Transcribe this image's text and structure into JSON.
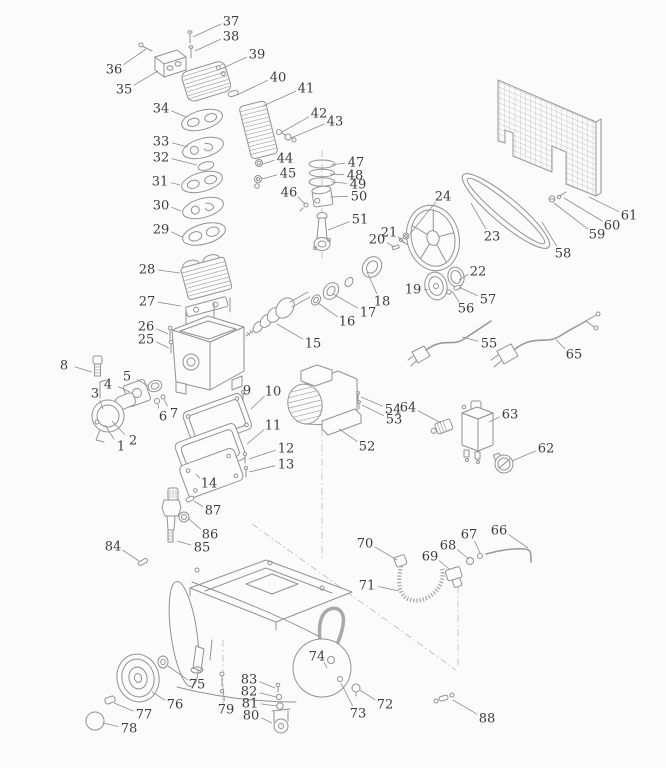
{
  "figure": {
    "type": "exploded-parts-diagram",
    "subject_hint": "belt-driven air compressor exploded view",
    "canvas": {
      "width": 666,
      "height": 768
    },
    "colors": {
      "background": "#fbfbfb",
      "line": "#929292",
      "label": "#3c3c3c",
      "leader": "#8c8c8c"
    },
    "label_font_size": 13,
    "part_count": 88
  },
  "labels": [
    {
      "n": "1",
      "x": 121,
      "y": 446,
      "ex": 105,
      "ey": 425
    },
    {
      "n": "2",
      "x": 133,
      "y": 440,
      "ex": 112,
      "ey": 421
    },
    {
      "n": "3",
      "x": 95,
      "y": 393,
      "ex": 103,
      "ey": 409
    },
    {
      "n": "4",
      "x": 108,
      "y": 384,
      "ex": 130,
      "ey": 392
    },
    {
      "n": "5",
      "x": 127,
      "y": 376,
      "ex": 148,
      "ey": 386
    },
    {
      "n": "6",
      "x": 163,
      "y": 416,
      "ex": 158,
      "ey": 404
    },
    {
      "n": "7",
      "x": 174,
      "y": 413,
      "ex": 164,
      "ey": 399
    },
    {
      "n": "8",
      "x": 64,
      "y": 365,
      "ex": 92,
      "ey": 372
    },
    {
      "n": "9",
      "x": 247,
      "y": 390,
      "ex": 243,
      "ey": 398
    },
    {
      "n": "10",
      "x": 273,
      "y": 391,
      "ex": 251,
      "ey": 409
    },
    {
      "n": "11",
      "x": 273,
      "y": 425,
      "ex": 247,
      "ey": 444
    },
    {
      "n": "12",
      "x": 286,
      "y": 448,
      "ex": 249,
      "ey": 459
    },
    {
      "n": "13",
      "x": 286,
      "y": 464,
      "ex": 249,
      "ey": 472
    },
    {
      "n": "14",
      "x": 209,
      "y": 483,
      "ex": 196,
      "ey": 474
    },
    {
      "n": "15",
      "x": 313,
      "y": 343,
      "ex": 277,
      "ey": 324
    },
    {
      "n": "16",
      "x": 347,
      "y": 321,
      "ex": 318,
      "ey": 303
    },
    {
      "n": "17",
      "x": 368,
      "y": 312,
      "ex": 333,
      "ey": 294
    },
    {
      "n": "18",
      "x": 382,
      "y": 301,
      "ex": 367,
      "ey": 272
    },
    {
      "n": "19",
      "x": 413,
      "y": 289,
      "ex": 428,
      "ey": 290
    },
    {
      "n": "20",
      "x": 377,
      "y": 239,
      "ex": 394,
      "ey": 247
    },
    {
      "n": "21",
      "x": 389,
      "y": 232,
      "ex": 404,
      "ey": 243
    },
    {
      "n": "22",
      "x": 478,
      "y": 271,
      "ex": 459,
      "ey": 280
    },
    {
      "n": "23",
      "x": 492,
      "y": 236,
      "ex": 471,
      "ey": 203
    },
    {
      "n": "24",
      "x": 443,
      "y": 196,
      "ex": 410,
      "ey": 234
    },
    {
      "n": "25",
      "x": 146,
      "y": 339,
      "ex": 169,
      "ey": 348
    },
    {
      "n": "26",
      "x": 146,
      "y": 326,
      "ex": 168,
      "ey": 334
    },
    {
      "n": "27",
      "x": 147,
      "y": 301,
      "ex": 181,
      "ey": 306
    },
    {
      "n": "28",
      "x": 147,
      "y": 269,
      "ex": 180,
      "ey": 273
    },
    {
      "n": "29",
      "x": 161,
      "y": 229,
      "ex": 182,
      "ey": 237
    },
    {
      "n": "30",
      "x": 161,
      "y": 205,
      "ex": 181,
      "ey": 211
    },
    {
      "n": "31",
      "x": 160,
      "y": 181,
      "ex": 180,
      "ey": 185
    },
    {
      "n": "32",
      "x": 161,
      "y": 157,
      "ex": 197,
      "ey": 165
    },
    {
      "n": "33",
      "x": 161,
      "y": 141,
      "ex": 188,
      "ey": 147
    },
    {
      "n": "34",
      "x": 161,
      "y": 108,
      "ex": 186,
      "ey": 117
    },
    {
      "n": "35",
      "x": 124,
      "y": 89,
      "ex": 158,
      "ey": 71
    },
    {
      "n": "36",
      "x": 114,
      "y": 69,
      "ex": 146,
      "ey": 49
    },
    {
      "n": "37",
      "x": 231,
      "y": 21,
      "ex": 193,
      "ey": 37
    },
    {
      "n": "38",
      "x": 231,
      "y": 36,
      "ex": 195,
      "ey": 51
    },
    {
      "n": "39",
      "x": 257,
      "y": 54,
      "ex": 221,
      "ey": 69
    },
    {
      "n": "40",
      "x": 278,
      "y": 77,
      "ex": 237,
      "ey": 95
    },
    {
      "n": "41",
      "x": 306,
      "y": 88,
      "ex": 263,
      "ey": 106
    },
    {
      "n": "42",
      "x": 319,
      "y": 113,
      "ex": 282,
      "ey": 132
    },
    {
      "n": "43",
      "x": 335,
      "y": 121,
      "ex": 291,
      "ey": 138
    },
    {
      "n": "44",
      "x": 285,
      "y": 158,
      "ex": 263,
      "ey": 164
    },
    {
      "n": "45",
      "x": 288,
      "y": 173,
      "ex": 262,
      "ey": 179
    },
    {
      "n": "46",
      "x": 289,
      "y": 192,
      "ex": 305,
      "ey": 204
    },
    {
      "n": "47",
      "x": 356,
      "y": 162,
      "ex": 331,
      "ey": 165
    },
    {
      "n": "48",
      "x": 355,
      "y": 175,
      "ex": 330,
      "ey": 174
    },
    {
      "n": "49",
      "x": 358,
      "y": 184,
      "ex": 331,
      "ey": 182
    },
    {
      "n": "50",
      "x": 359,
      "y": 196,
      "ex": 330,
      "ey": 197
    },
    {
      "n": "51",
      "x": 360,
      "y": 219,
      "ex": 328,
      "ey": 230
    },
    {
      "n": "52",
      "x": 367,
      "y": 446,
      "ex": 339,
      "ey": 429
    },
    {
      "n": "53",
      "x": 394,
      "y": 419,
      "ex": 362,
      "ey": 405
    },
    {
      "n": "54",
      "x": 393,
      "y": 409,
      "ex": 361,
      "ey": 397
    },
    {
      "n": "55",
      "x": 489,
      "y": 343,
      "ex": 462,
      "ey": 337
    },
    {
      "n": "56",
      "x": 466,
      "y": 308,
      "ex": 452,
      "ey": 291
    },
    {
      "n": "57",
      "x": 488,
      "y": 299,
      "ex": 459,
      "ey": 287
    },
    {
      "n": "58",
      "x": 563,
      "y": 253,
      "ex": 542,
      "ey": 222
    },
    {
      "n": "59",
      "x": 597,
      "y": 234,
      "ex": 554,
      "ey": 203
    },
    {
      "n": "60",
      "x": 612,
      "y": 225,
      "ex": 564,
      "ey": 198
    },
    {
      "n": "61",
      "x": 629,
      "y": 215,
      "ex": 589,
      "ey": 197
    },
    {
      "n": "62",
      "x": 546,
      "y": 448,
      "ex": 512,
      "ey": 461
    },
    {
      "n": "63",
      "x": 510,
      "y": 414,
      "ex": 489,
      "ey": 422
    },
    {
      "n": "64",
      "x": 408,
      "y": 407,
      "ex": 441,
      "ey": 423
    },
    {
      "n": "65",
      "x": 574,
      "y": 354,
      "ex": 556,
      "ey": 340
    },
    {
      "n": "66",
      "x": 499,
      "y": 530,
      "ex": 528,
      "ey": 548
    },
    {
      "n": "67",
      "x": 469,
      "y": 534,
      "ex": 480,
      "ey": 553
    },
    {
      "n": "68",
      "x": 448,
      "y": 545,
      "ex": 469,
      "ey": 559
    },
    {
      "n": "69",
      "x": 430,
      "y": 556,
      "ex": 449,
      "ey": 569
    },
    {
      "n": "70",
      "x": 365,
      "y": 543,
      "ex": 397,
      "ey": 560
    },
    {
      "n": "71",
      "x": 367,
      "y": 585,
      "ex": 399,
      "ey": 591
    },
    {
      "n": "72",
      "x": 385,
      "y": 704,
      "ex": 360,
      "ey": 690
    },
    {
      "n": "73",
      "x": 358,
      "y": 713,
      "ex": 341,
      "ey": 683
    },
    {
      "n": "74",
      "x": 317,
      "y": 656,
      "ex": 327,
      "ey": 668
    },
    {
      "n": "75",
      "x": 197,
      "y": 684,
      "ex": 168,
      "ey": 666
    },
    {
      "n": "76",
      "x": 175,
      "y": 704,
      "ex": 152,
      "ey": 692
    },
    {
      "n": "77",
      "x": 144,
      "y": 714,
      "ex": 114,
      "ey": 703
    },
    {
      "n": "78",
      "x": 129,
      "y": 728,
      "ex": 103,
      "ey": 723
    },
    {
      "n": "79",
      "x": 226,
      "y": 709,
      "ex": 223,
      "ey": 688
    },
    {
      "n": "80",
      "x": 251,
      "y": 715,
      "ex": 272,
      "ey": 723
    },
    {
      "n": "81",
      "x": 250,
      "y": 703,
      "ex": 277,
      "ey": 706
    },
    {
      "n": "82",
      "x": 249,
      "y": 691,
      "ex": 276,
      "ey": 697
    },
    {
      "n": "83",
      "x": 249,
      "y": 679,
      "ex": 275,
      "ey": 688
    },
    {
      "n": "84",
      "x": 113,
      "y": 546,
      "ex": 139,
      "ey": 561
    },
    {
      "n": "85",
      "x": 202,
      "y": 547,
      "ex": 177,
      "ey": 541
    },
    {
      "n": "86",
      "x": 210,
      "y": 534,
      "ex": 189,
      "ey": 519
    },
    {
      "n": "87",
      "x": 213,
      "y": 510,
      "ex": 194,
      "ey": 501
    },
    {
      "n": "88",
      "x": 487,
      "y": 718,
      "ex": 453,
      "ey": 700
    }
  ]
}
